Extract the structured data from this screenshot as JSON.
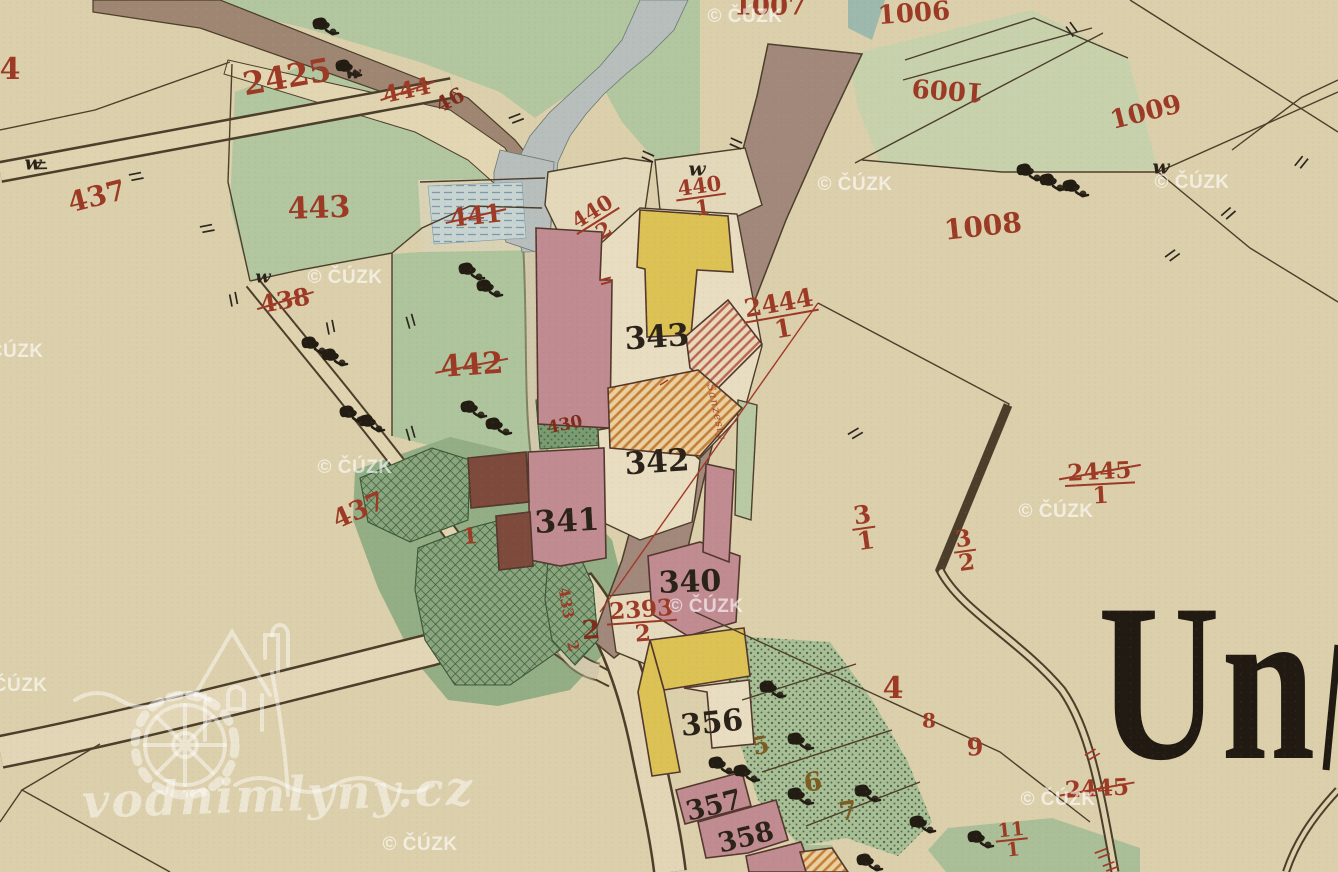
{
  "map": {
    "place_name_fragment": "Un",
    "parcel_labels": [
      {
        "t": "4",
        "x": 10,
        "y": 70,
        "s": 30,
        "r": 0,
        "c": "red"
      },
      {
        "t": "2425",
        "x": 287,
        "y": 77,
        "s": 32,
        "r": -10,
        "c": "red"
      },
      {
        "t": "444",
        "x": 407,
        "y": 91,
        "s": 23,
        "r": -12,
        "c": "red",
        "strike": true
      },
      {
        "t": "46",
        "x": 450,
        "y": 100,
        "s": 21,
        "r": -28,
        "c": "darkred"
      },
      {
        "t": "437",
        "x": 97,
        "y": 197,
        "s": 28,
        "r": -14,
        "c": "red"
      },
      {
        "t": "443",
        "x": 319,
        "y": 209,
        "s": 30,
        "r": -2,
        "c": "red"
      },
      {
        "t": "441",
        "x": 476,
        "y": 216,
        "s": 25,
        "r": -6,
        "c": "red",
        "strike": true
      },
      {
        "n": "440",
        "d": "2",
        "x": 598,
        "y": 221,
        "s": 21,
        "r": -32,
        "c": "red"
      },
      {
        "n": "440",
        "d": "1",
        "x": 701,
        "y": 197,
        "s": 21,
        "r": -8,
        "c": "red"
      },
      {
        "t": "438",
        "x": 285,
        "y": 301,
        "s": 24,
        "r": -10,
        "c": "red",
        "strike": true
      },
      {
        "t": "442",
        "x": 472,
        "y": 366,
        "s": 30,
        "r": -4,
        "c": "red",
        "strike": true
      },
      {
        "t": "430",
        "x": 565,
        "y": 425,
        "s": 17,
        "r": -12,
        "c": "darkred"
      },
      {
        "t": "437",
        "x": 359,
        "y": 511,
        "s": 26,
        "r": -24,
        "c": "red"
      },
      {
        "t": "1",
        "x": 470,
        "y": 537,
        "s": 22,
        "r": -6,
        "c": "red"
      },
      {
        "t": "433",
        "x": 566,
        "y": 603,
        "s": 15,
        "r": 80,
        "c": "red"
      },
      {
        "t": "2",
        "x": 573,
        "y": 646,
        "s": 15,
        "r": 70,
        "c": "red"
      },
      {
        "t": "2",
        "x": 591,
        "y": 631,
        "s": 26,
        "r": -4,
        "c": "darkred"
      },
      {
        "n": "2393",
        "d": "2",
        "x": 642,
        "y": 622,
        "s": 23,
        "r": -4,
        "c": "red"
      },
      {
        "n": "2444",
        "d": "1",
        "x": 781,
        "y": 316,
        "s": 25,
        "r": -10,
        "c": "red"
      },
      {
        "n": "2445",
        "d": "1",
        "x": 1100,
        "y": 484,
        "s": 23,
        "r": -3,
        "c": "red",
        "strike": true
      },
      {
        "n": "3",
        "d": "1",
        "x": 864,
        "y": 528,
        "s": 25,
        "r": -8,
        "c": "red"
      },
      {
        "n": "3",
        "d": "2",
        "x": 965,
        "y": 551,
        "s": 23,
        "r": -8,
        "c": "red"
      },
      {
        "t": "4",
        "x": 893,
        "y": 689,
        "s": 30,
        "r": 0,
        "c": "red"
      },
      {
        "t": "8",
        "x": 929,
        "y": 721,
        "s": 20,
        "r": 0,
        "c": "red"
      },
      {
        "t": "9",
        "x": 975,
        "y": 748,
        "s": 24,
        "r": 0,
        "c": "red"
      },
      {
        "n": "11",
        "d": "1",
        "x": 1012,
        "y": 840,
        "s": 19,
        "r": -6,
        "c": "red"
      },
      {
        "t": "2445",
        "x": 1097,
        "y": 789,
        "s": 23,
        "r": -3,
        "c": "red",
        "strike": true
      },
      {
        "t": "1006",
        "x": 914,
        "y": 14,
        "s": 26,
        "r": -4,
        "c": "red"
      },
      {
        "t": "1007",
        "x": 770,
        "y": 7,
        "s": 26,
        "r": 0,
        "c": "red"
      },
      {
        "t": "1009",
        "x": 948,
        "y": 89,
        "s": 26,
        "r": 184,
        "c": "red"
      },
      {
        "t": "1009",
        "x": 1146,
        "y": 113,
        "s": 26,
        "r": -14,
        "c": "red"
      },
      {
        "t": "1008",
        "x": 983,
        "y": 227,
        "s": 28,
        "r": -6,
        "c": "red"
      },
      {
        "t": "=",
        "x": 606,
        "y": 281,
        "s": 18,
        "r": -15,
        "c": "red"
      },
      {
        "t": "Sanzesty",
        "x": 716,
        "y": 412,
        "s": 11,
        "r": 78,
        "c": "red",
        "script": true
      },
      {
        "t": "343",
        "x": 657,
        "y": 338,
        "s": 31,
        "r": -4,
        "c": "ink"
      },
      {
        "t": "342",
        "x": 657,
        "y": 463,
        "s": 31,
        "r": -4,
        "c": "ink"
      },
      {
        "t": "341",
        "x": 567,
        "y": 522,
        "s": 31,
        "r": -3,
        "c": "ink"
      },
      {
        "t": "340",
        "x": 690,
        "y": 583,
        "s": 30,
        "r": -2,
        "c": "ink"
      },
      {
        "t": "356",
        "x": 712,
        "y": 724,
        "s": 30,
        "r": -6,
        "c": "ink"
      },
      {
        "t": "357",
        "x": 714,
        "y": 806,
        "s": 27,
        "r": -14,
        "c": "ink"
      },
      {
        "t": "358",
        "x": 746,
        "y": 838,
        "s": 27,
        "r": -14,
        "c": "ink"
      },
      {
        "t": "w",
        "x": 33,
        "y": 163,
        "s": 20,
        "r": 0,
        "c": "ink",
        "italic": true
      },
      {
        "t": "w",
        "x": 263,
        "y": 277,
        "s": 18,
        "r": 0,
        "c": "ink",
        "italic": true
      },
      {
        "t": "w",
        "x": 353,
        "y": 73,
        "s": 18,
        "r": 0,
        "c": "ink",
        "italic": true
      },
      {
        "t": "w",
        "x": 697,
        "y": 169,
        "s": 20,
        "r": 0,
        "c": "ink",
        "italic": true
      },
      {
        "t": "w",
        "x": 1161,
        "y": 167,
        "s": 20,
        "r": 0,
        "c": "ink",
        "italic": true
      },
      {
        "t": "5",
        "x": 761,
        "y": 746,
        "s": 24,
        "r": -12,
        "c": "olive"
      },
      {
        "t": "6",
        "x": 813,
        "y": 783,
        "s": 26,
        "r": -8,
        "c": "olive"
      },
      {
        "t": "7",
        "x": 848,
        "y": 812,
        "s": 26,
        "r": -8,
        "c": "olive"
      }
    ],
    "trees": [
      [
        320,
        25
      ],
      [
        343,
        67
      ],
      [
        466,
        270
      ],
      [
        484,
        287
      ],
      [
        309,
        344
      ],
      [
        329,
        356
      ],
      [
        347,
        413
      ],
      [
        366,
        422
      ],
      [
        468,
        408
      ],
      [
        493,
        425
      ],
      [
        1024,
        171
      ],
      [
        1047,
        181
      ],
      [
        1070,
        187
      ],
      [
        716,
        764
      ],
      [
        767,
        688
      ],
      [
        795,
        740
      ],
      [
        795,
        795
      ],
      [
        862,
        792
      ],
      [
        917,
        823
      ],
      [
        864,
        861
      ],
      [
        975,
        838
      ],
      [
        741,
        772
      ]
    ],
    "ticks_black": [
      [
        136,
        176,
        -25
      ],
      [
        207,
        228,
        -25
      ],
      [
        234,
        299,
        65
      ],
      [
        331,
        327,
        65
      ],
      [
        411,
        321,
        60
      ],
      [
        411,
        433,
        60
      ],
      [
        516,
        118,
        -35
      ],
      [
        648,
        156,
        10
      ],
      [
        736,
        143,
        10
      ],
      [
        1072,
        29,
        40
      ],
      [
        1301,
        162,
        -65
      ],
      [
        1228,
        213,
        -55
      ],
      [
        1172,
        255,
        -50
      ],
      [
        855,
        433,
        -45
      ],
      [
        40,
        165,
        -15
      ]
    ],
    "ticks_red": [
      [
        1092,
        754,
        -45
      ],
      [
        1102,
        853,
        -35
      ],
      [
        1110,
        866,
        -35
      ]
    ],
    "watermarks": {
      "cuzk_text": "© ČÚZK",
      "cuzk_positions": [
        [
          745,
          17
        ],
        [
          855,
          185
        ],
        [
          1192,
          183
        ],
        [
          6,
          352
        ],
        [
          345,
          278
        ],
        [
          355,
          468
        ],
        [
          10,
          686
        ],
        [
          706,
          607
        ],
        [
          1056,
          512
        ],
        [
          1058,
          800
        ],
        [
          420,
          845
        ]
      ],
      "site_text": "vodnimlyny.cz"
    }
  },
  "palette": {
    "parchment": "#dccfab",
    "parcel_white": "#e8ddc0",
    "meadow_green": "#b2c6a0",
    "pale_green": "#c7d2ad",
    "garden_green": "#aabf97",
    "dark_garden": "#8aa67e",
    "road_brown": "#a1887a",
    "path_tan": "#e0d3af",
    "stream_grey": "#b7bebc",
    "building_pink": "#c08b91",
    "building_dark": "#7d4a3c",
    "building_yellow": "#dcc254",
    "label_red": "#9c3a26",
    "ink_black": "#2b231a",
    "line_sepia": "#4c3e2b"
  }
}
